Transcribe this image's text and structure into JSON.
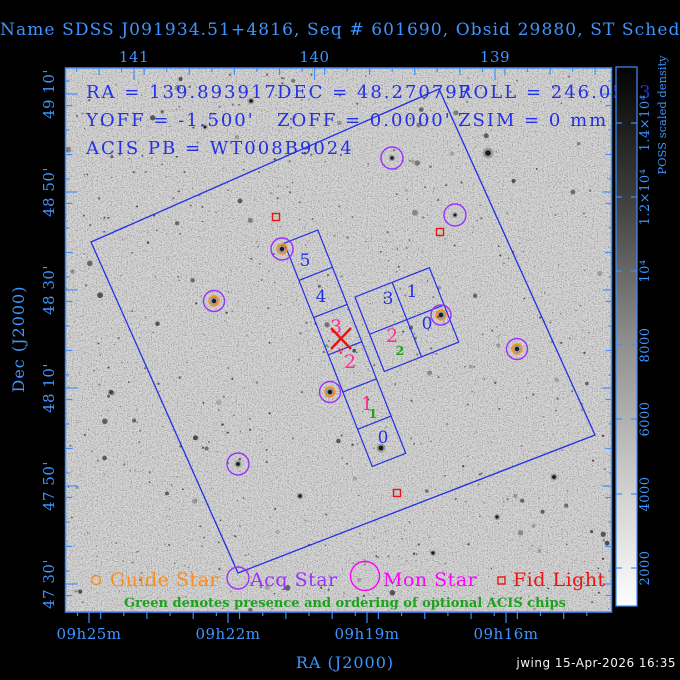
{
  "title": "Name SDSS J091934.51+4816, Seq # 601690, Obsid 29880, ST Scheduled",
  "annotations": {
    "ra": "RA = 139.893917",
    "dec": "DEC = 48.270797",
    "roll": "ROLL = 246.0543",
    "yoff": "YOFF = -1.500'",
    "zoff": "ZOFF = 0.0000'",
    "zsim": "ZSIM = 0 mm",
    "acis_pb": "ACIS PB = WT008B9024"
  },
  "axes": {
    "top": {
      "ticks": [
        "141",
        "140",
        "139"
      ]
    },
    "bottom": {
      "label": "RA (J2000)",
      "ticks": [
        "09h25m",
        "09h22m",
        "09h19m",
        "09h16m"
      ]
    },
    "left": {
      "label": "Dec (J2000)",
      "ticks": [
        "49 10'",
        "48 50'",
        "48 30'",
        "48 10'",
        "47 50'",
        "47 30'"
      ]
    }
  },
  "colorbar": {
    "title": "POSS scaled density",
    "ticks": [
      "1.4×10⁴",
      "1.2×10⁴",
      "10⁴",
      "8000",
      "6000",
      "4000",
      "2000"
    ]
  },
  "chips": {
    "s5": "5",
    "s4": "4",
    "s3": "3",
    "s2": "2",
    "s1": "1",
    "s0": "0",
    "i3": "3",
    "i1": "1",
    "i2": "2",
    "i0": "0",
    "opt1": "1",
    "opt2": "2",
    "aim_mark": "v"
  },
  "legend": {
    "guide": "Guide Star",
    "acq": "Acq Star",
    "mon": "Mon Star",
    "fid": "Fid Light",
    "note": "Green denotes presence and ordering of optional ACIS chips"
  },
  "footer": {
    "credit": "jwing 15-Apr-2026 16:35"
  },
  "colors": {
    "title_blue": "#3d95ff",
    "annotation_blue": "#2230e6",
    "frame_blue": "#3f8fff",
    "chip_selected_magenta": "#ff2d95",
    "optional_green": "#1fa11f",
    "fid_red": "#ee1111",
    "guide_orange": "#ff8c1a",
    "acq_purple": "#9b30ff",
    "mon_magenta": "#ff00ff",
    "plot_background": "#d7d7d7"
  }
}
